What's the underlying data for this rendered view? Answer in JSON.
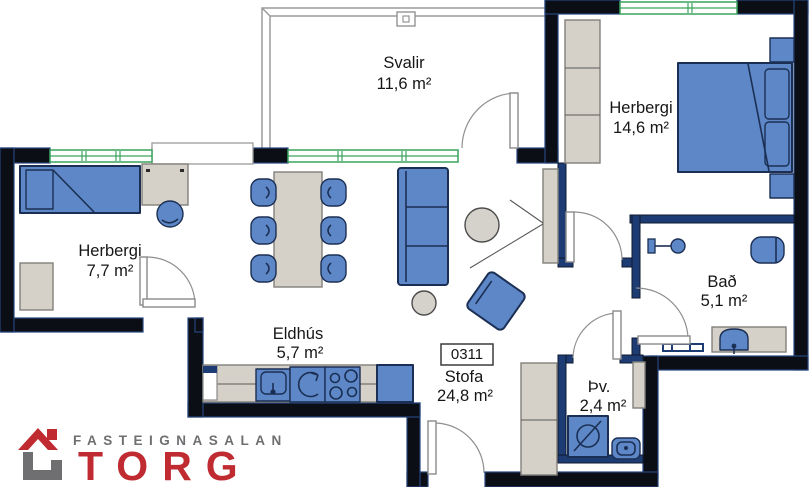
{
  "floorplan": {
    "unit_label": "0311",
    "rooms": {
      "balcony": {
        "name": "Svalir",
        "area": "11,6 m²"
      },
      "bedroom_main": {
        "name": "Herbergi",
        "area": "14,6 m²"
      },
      "bedroom_small": {
        "name": "Herbergi",
        "area": "7,7 m²"
      },
      "kitchen": {
        "name": "Eldhús",
        "area": "5,7 m²"
      },
      "living": {
        "name": "Stofa",
        "area": "24,8 m²"
      },
      "bathroom": {
        "name": "Bað",
        "area": "5,1 m²"
      },
      "laundry": {
        "name": "Þv.",
        "area": "2,4 m²"
      }
    },
    "colors": {
      "exterior_wall": "#0b0e14",
      "interior_wall": "#1e3c74",
      "furniture_blue": "#5d87c6",
      "furniture_outline": "#1b2f54",
      "wood_beige": "#d6d1c8",
      "window_green": "#3aa35c",
      "door_gray": "#8a8a8a"
    }
  },
  "logo": {
    "agency": "FASTEIGNASALAN",
    "brand": "TORG",
    "red": "#bf2b31",
    "gray": "#6f6f72"
  }
}
